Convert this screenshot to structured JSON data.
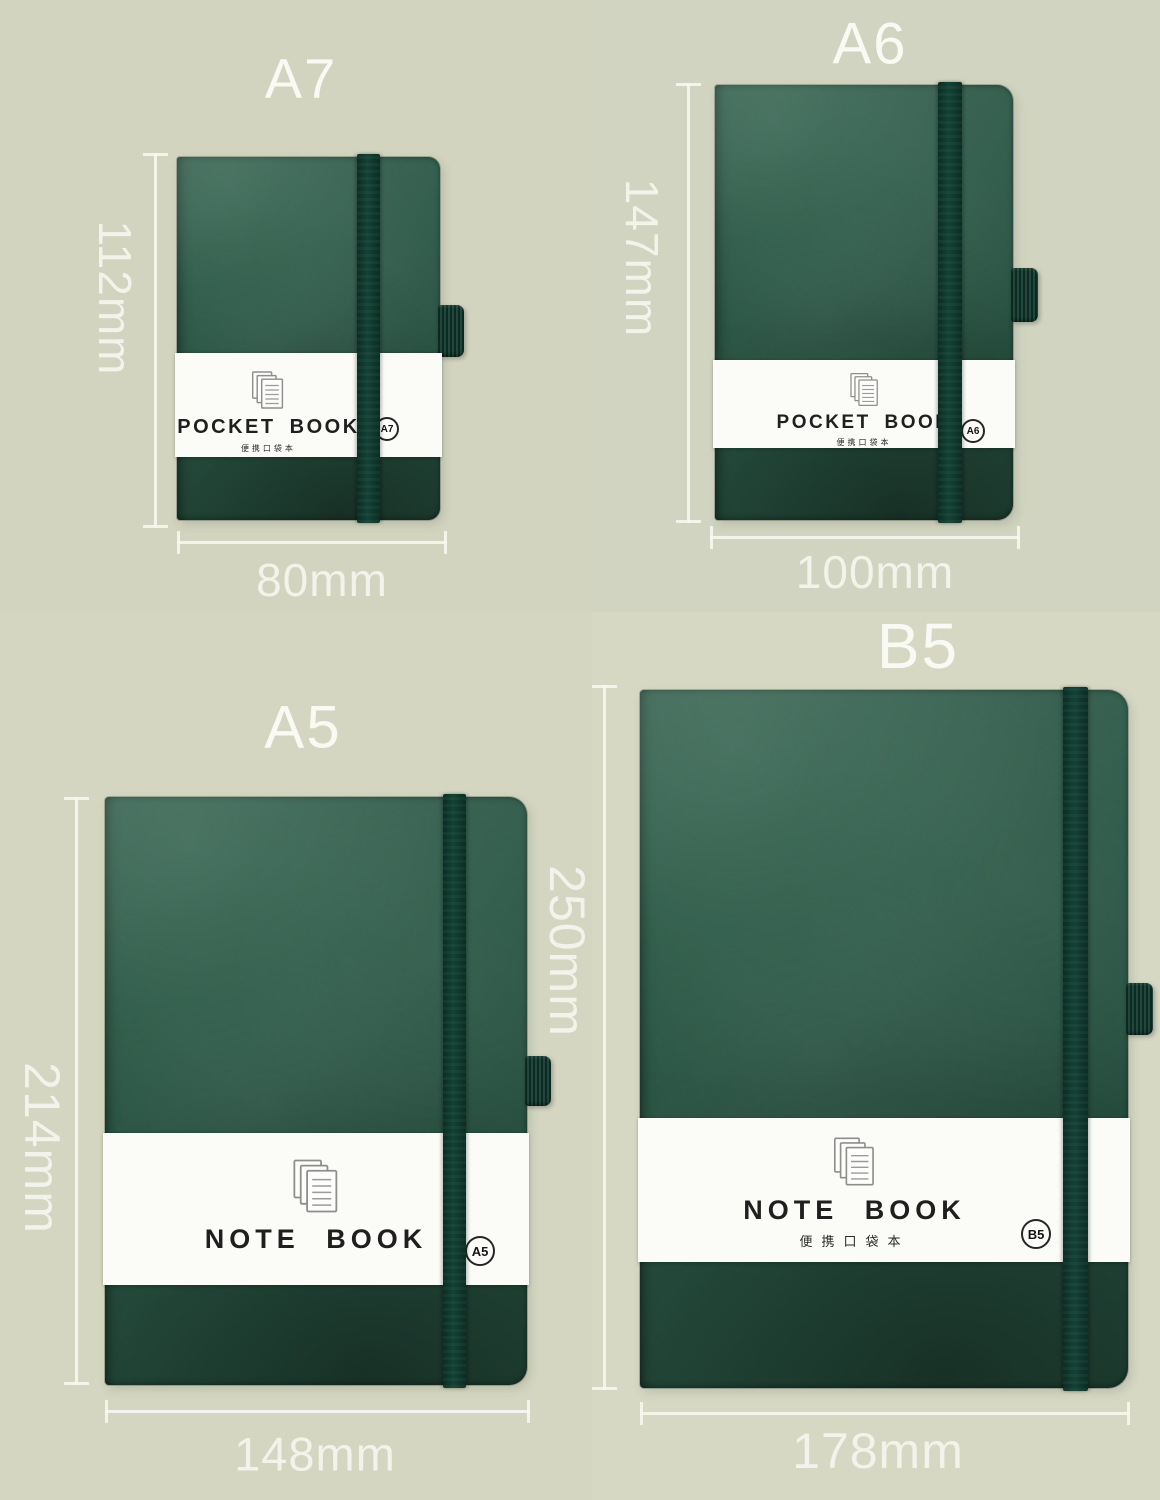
{
  "page": {
    "description": "Notebook size comparison product image",
    "colors": {
      "background": "#d3d5c0",
      "cover_green": "#2b5746",
      "cover_green_dark": "#1d4334",
      "elastic_green": "#0e352b",
      "band_white": "#fbfbf8",
      "band_text": "#1f1f1f",
      "annotation_white": "#f2f3ea"
    }
  },
  "notebooks": [
    {
      "id": "a7",
      "title": "A7",
      "height_label": "112mm",
      "width_label": "80mm",
      "band_title": "POCKET BOOK",
      "band_subtitle": "便携口袋本",
      "badge": "A7",
      "icon": "paper-stack-icon"
    },
    {
      "id": "a6",
      "title": "A6",
      "height_label": "147mm",
      "width_label": "100mm",
      "band_title": "POCKET BOOK",
      "band_subtitle": "便携口袋本",
      "badge": "A6",
      "icon": "paper-stack-icon"
    },
    {
      "id": "a5",
      "title": "A5",
      "height_label": "214mm",
      "width_label": "148mm",
      "band_title": "NOTE BOOK",
      "band_subtitle": "",
      "badge": "A5",
      "icon": "paper-stack-icon"
    },
    {
      "id": "b5",
      "title": "B5",
      "height_label": "250mm",
      "width_label": "178mm",
      "band_title": "NOTE BOOK",
      "band_subtitle": "便携口袋本",
      "badge": "B5",
      "icon": "paper-stack-icon"
    }
  ]
}
